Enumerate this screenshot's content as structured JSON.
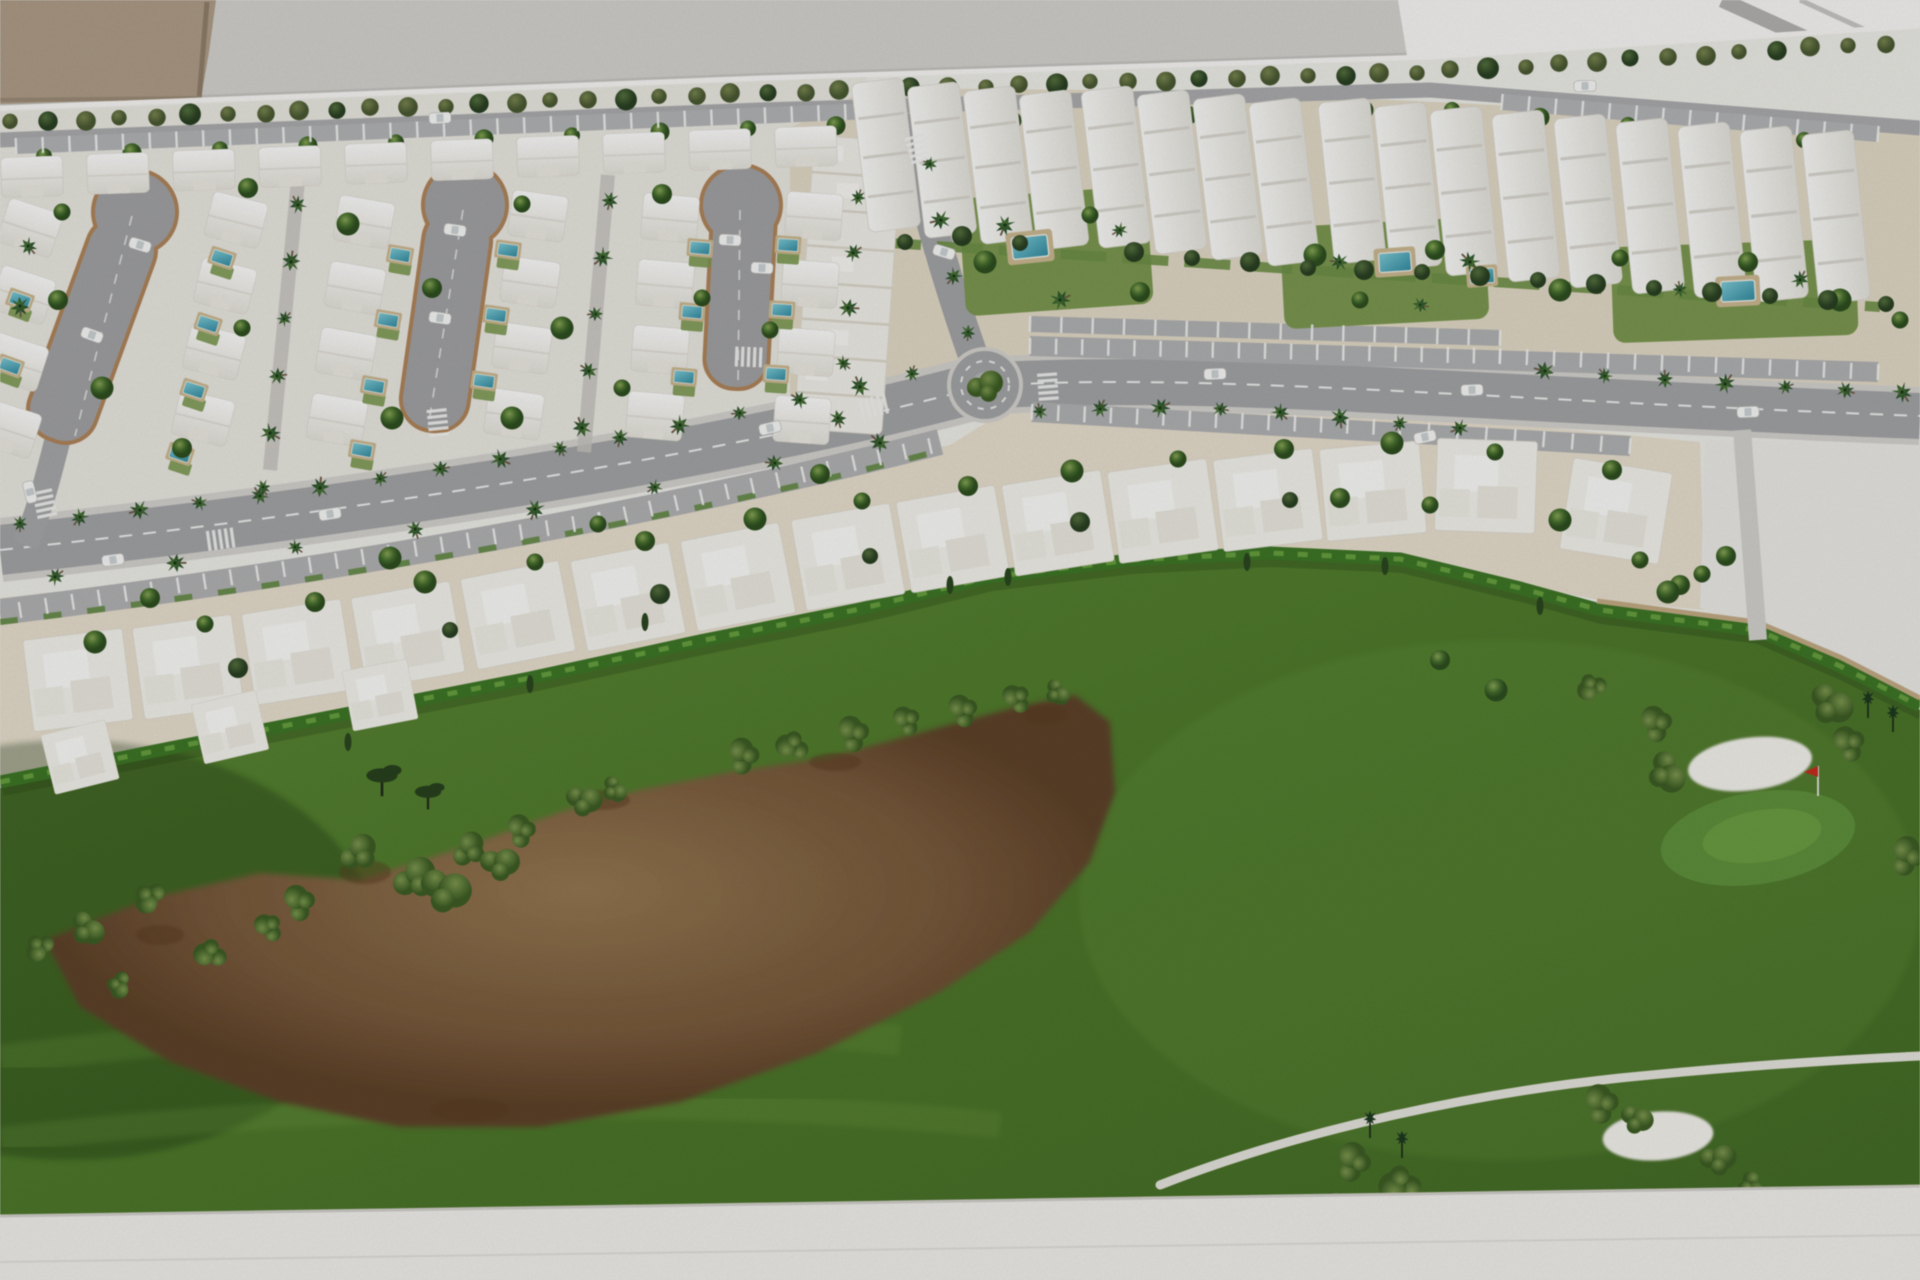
{
  "scene": {
    "palette": {
      "wall": "#d8d6d2",
      "bright": "#fbfaf8",
      "stripe": "#b7b5b2",
      "beige_object": "#b2a089",
      "board": "#f1f0eb",
      "ground_left": "#edebe3",
      "ground_tan": "#e6ddc8",
      "villa_ground": "#ebe2cf",
      "parcel": "#eeede9",
      "road": "#a7a8aa",
      "top_road": "#aeafb1",
      "lane": "#b3b4b6",
      "sidewalk": "#d8d6d1",
      "brick_edge": "#b5875a",
      "hedge": "#3e7b26",
      "grass_light": "#5d8c33",
      "grass_dark": "#456f25",
      "sand_brown": "#7c5c3b",
      "bunker": "#f6f5ef",
      "pool_water": "#3f9cb0",
      "pool_deck": "#cfbb92",
      "garden_green": "#7d9c4f",
      "tree_green": "#46702c",
      "tree_dark": "#2b4423",
      "palm_green": "#27512a",
      "flag_red": "#d22d1e",
      "car_white": "#fbfbfa",
      "base": "#f4f3ef"
    },
    "lines": {
      "edge": [
        [
          0,
          108
        ],
        [
          760,
          78
        ],
        [
          1428,
          57
        ],
        [
          1920,
          26
        ]
      ],
      "toproad": [
        [
          0,
          136
        ],
        [
          760,
          106
        ],
        [
          1430,
          86
        ],
        [
          1920,
          128
        ]
      ]
    },
    "gen": {
      "olive_row": {
        "x0": 12,
        "x1": 1908,
        "step": 36,
        "dy": 15
      },
      "row_b": {
        "x0": 44,
        "x1": 1876,
        "step": 88,
        "dy": 22,
        "skip": [
          878,
          1012
        ]
      }
    },
    "house_cols": [
      {
        "x0": 30,
        "y0": 228,
        "n": 4,
        "dx": -7,
        "dy": 67,
        "rot": 18
      },
      {
        "x0": 236,
        "y0": 220,
        "n": 4,
        "dx": -11,
        "dy": 66,
        "rot": 14
      },
      {
        "x0": 364,
        "y0": 222,
        "n": 4,
        "dx": -9,
        "dy": 66,
        "rot": 10
      },
      {
        "x0": 538,
        "y0": 216,
        "n": 4,
        "dx": -8,
        "dy": 66,
        "rot": 8
      },
      {
        "x0": 670,
        "y0": 218,
        "n": 4,
        "dx": -5,
        "dy": 66,
        "rot": 5
      },
      {
        "x0": 814,
        "y0": 216,
        "n": 4,
        "dx": -4,
        "dy": 68,
        "rot": 4
      }
    ],
    "top_row": {
      "x0": 32,
      "n": 10,
      "dx": 86,
      "dy": 42,
      "rot": -2,
      "sx": 1.1,
      "sy": 0.87
    },
    "terrace": {
      "cx": 848,
      "cy": 285,
      "w": 88,
      "h": 294,
      "rot": 4,
      "steps": 8
    },
    "villas": [
      [
        78,
        680,
        -7,
        1
      ],
      [
        188,
        667,
        -8,
        1
      ],
      [
        298,
        652,
        -9,
        1
      ],
      [
        408,
        635,
        -10,
        1
      ],
      [
        518,
        615,
        -11,
        1
      ],
      [
        628,
        597,
        -11,
        1
      ],
      [
        738,
        577,
        -11,
        1
      ],
      [
        848,
        557,
        -10,
        1
      ],
      [
        953,
        539,
        -10,
        1
      ],
      [
        1058,
        523,
        -9,
        1
      ],
      [
        1163,
        511,
        -8,
        1
      ],
      [
        1268,
        500,
        -7,
        1
      ],
      [
        1373,
        491,
        -5,
        1
      ],
      [
        1486,
        486,
        2,
        1
      ],
      [
        1616,
        511,
        9,
        1
      ],
      [
        80,
        757,
        -14,
        0.66
      ],
      [
        230,
        727,
        -13,
        0.66
      ],
      [
        380,
        695,
        -11,
        0.66
      ]
    ],
    "blocks": [
      [
        886,
        155,
        150,
        -7
      ],
      [
        942,
        160,
        152,
        -7
      ],
      [
        998,
        165,
        154,
        -7
      ],
      [
        1054,
        170,
        156,
        -7
      ],
      [
        1116,
        167,
        158,
        -7
      ],
      [
        1172,
        172,
        160,
        -7
      ],
      [
        1228,
        177,
        162,
        -7
      ],
      [
        1284,
        182,
        164,
        -7
      ],
      [
        1352,
        181,
        162,
        -6
      ],
      [
        1408,
        186,
        164,
        -6
      ],
      [
        1464,
        191,
        166,
        -6
      ],
      [
        1526,
        196,
        168,
        -6
      ],
      [
        1588,
        201,
        170,
        -6
      ],
      [
        1650,
        206,
        172,
        -6
      ],
      [
        1712,
        210,
        172,
        -6
      ],
      [
        1774,
        214,
        172,
        -6
      ],
      [
        1836,
        217,
        170,
        -6
      ]
    ],
    "pools": [
      [
        222,
        258,
        18,
        1
      ],
      [
        208,
        324,
        18,
        1
      ],
      [
        194,
        390,
        18,
        1
      ],
      [
        180,
        454,
        18,
        1
      ],
      [
        400,
        255,
        10,
        1
      ],
      [
        388,
        320,
        10,
        1
      ],
      [
        374,
        386,
        10,
        1
      ],
      [
        362,
        450,
        10,
        1
      ],
      [
        508,
        250,
        8,
        1
      ],
      [
        496,
        315,
        8,
        1
      ],
      [
        484,
        381,
        8,
        1
      ],
      [
        700,
        248,
        5,
        1
      ],
      [
        692,
        312,
        5,
        1
      ],
      [
        684,
        377,
        5,
        1
      ],
      [
        788,
        245,
        4,
        1
      ],
      [
        782,
        310,
        4,
        1
      ],
      [
        776,
        374,
        4,
        1
      ],
      [
        20,
        300,
        20,
        1
      ],
      [
        10,
        366,
        20,
        1
      ],
      [
        1030,
        247,
        -6,
        1.8
      ],
      [
        1395,
        262,
        -4,
        1.6
      ],
      [
        1482,
        276,
        -4,
        1.2
      ],
      [
        1738,
        291,
        -3,
        1.7
      ]
    ],
    "palms": [
      [
        20,
        523
      ],
      [
        80,
        517
      ],
      [
        140,
        510
      ],
      [
        200,
        503
      ],
      [
        260,
        496
      ],
      [
        320,
        488
      ],
      [
        380,
        479
      ],
      [
        440,
        469
      ],
      [
        500,
        459
      ],
      [
        560,
        448
      ],
      [
        620,
        437
      ],
      [
        680,
        425
      ],
      [
        740,
        413
      ],
      [
        800,
        400
      ],
      [
        860,
        387
      ],
      [
        912,
        374
      ],
      [
        55,
        577
      ],
      [
        175,
        563
      ],
      [
        295,
        547
      ],
      [
        415,
        529
      ],
      [
        535,
        509
      ],
      [
        655,
        487
      ],
      [
        775,
        463
      ],
      [
        880,
        443
      ],
      [
        1040,
        412
      ],
      [
        1100,
        409
      ],
      [
        1160,
        408
      ],
      [
        1220,
        409
      ],
      [
        1280,
        412
      ],
      [
        1340,
        417
      ],
      [
        1400,
        423
      ],
      [
        1460,
        428
      ],
      [
        1545,
        371
      ],
      [
        1605,
        376
      ],
      [
        1665,
        380
      ],
      [
        1725,
        384
      ],
      [
        1785,
        387
      ],
      [
        1845,
        390
      ],
      [
        1902,
        392
      ],
      [
        968,
        332
      ],
      [
        954,
        276
      ],
      [
        941,
        220
      ],
      [
        930,
        164
      ],
      [
        298,
        205
      ],
      [
        291,
        262
      ],
      [
        284,
        319
      ],
      [
        277,
        376
      ],
      [
        270,
        433
      ],
      [
        263,
        487
      ],
      [
        610,
        200
      ],
      [
        603,
        257
      ],
      [
        596,
        314
      ],
      [
        589,
        371
      ],
      [
        582,
        428
      ],
      [
        858,
        198
      ],
      [
        853,
        253
      ],
      [
        848,
        308
      ],
      [
        843,
        363
      ],
      [
        838,
        418
      ],
      [
        1005,
        225
      ],
      [
        1120,
        230
      ],
      [
        1340,
        262
      ],
      [
        1470,
        262
      ],
      [
        1680,
        290
      ],
      [
        1800,
        280
      ],
      [
        1060,
        300
      ],
      [
        1420,
        305
      ],
      [
        28,
        246
      ],
      [
        20,
        306
      ]
    ],
    "trees": [
      [
        62,
        212
      ],
      [
        248,
        188
      ],
      [
        348,
        224
      ],
      [
        522,
        204
      ],
      [
        662,
        194
      ],
      [
        102,
        388
      ],
      [
        242,
        328
      ],
      [
        432,
        288
      ],
      [
        562,
        328
      ],
      [
        702,
        298
      ],
      [
        182,
        448
      ],
      [
        392,
        418
      ],
      [
        622,
        388
      ],
      [
        58,
        300
      ],
      [
        512,
        418
      ],
      [
        770,
        330
      ],
      [
        150,
        598
      ],
      [
        390,
        558
      ],
      [
        598,
        524
      ],
      [
        820,
        474
      ],
      [
        95,
        642
      ],
      [
        205,
        624
      ],
      [
        315,
        602
      ],
      [
        425,
        582
      ],
      [
        535,
        562
      ],
      [
        645,
        541
      ],
      [
        755,
        519
      ],
      [
        862,
        501
      ],
      [
        968,
        486
      ],
      [
        1072,
        471
      ],
      [
        1178,
        459
      ],
      [
        1284,
        449
      ],
      [
        1392,
        443
      ],
      [
        1495,
        452
      ],
      [
        1612,
        470
      ],
      [
        1560,
        520
      ],
      [
        1640,
        560
      ],
      [
        1680,
        585
      ],
      [
        985,
        262
      ],
      [
        1090,
        215
      ],
      [
        1140,
        292
      ],
      [
        1315,
        255
      ],
      [
        1360,
        300
      ],
      [
        1435,
        250
      ],
      [
        1560,
        290
      ],
      [
        1620,
        258
      ],
      [
        1748,
        262
      ],
      [
        1840,
        300
      ],
      [
        1900,
        320
      ],
      [
        1440,
        660
      ],
      [
        1496,
        690
      ],
      [
        1702,
        574
      ],
      [
        1726,
        556
      ],
      [
        1668,
        592
      ],
      [
        1430,
        505
      ],
      [
        1340,
        498
      ]
    ],
    "dark_trees": [
      [
        905,
        242
      ],
      [
        962,
        236
      ],
      [
        1020,
        243
      ],
      [
        1134,
        252
      ],
      [
        1192,
        258
      ],
      [
        1250,
        262
      ],
      [
        1308,
        268
      ],
      [
        1364,
        270
      ],
      [
        1422,
        272
      ],
      [
        1480,
        276
      ],
      [
        1538,
        280
      ],
      [
        1596,
        284
      ],
      [
        1654,
        288
      ],
      [
        1712,
        292
      ],
      [
        1770,
        296
      ],
      [
        1828,
        300
      ],
      [
        1886,
        304
      ],
      [
        238,
        668
      ],
      [
        450,
        630
      ],
      [
        660,
        594
      ],
      [
        870,
        556
      ],
      [
        1080,
        522
      ],
      [
        1290,
        500
      ]
    ],
    "cypress": [
      [
        348,
        742
      ],
      [
        530,
        684
      ],
      [
        645,
        622
      ],
      [
        950,
        585
      ],
      [
        1008,
        577
      ],
      [
        1247,
        562
      ],
      [
        1385,
        566
      ],
      [
        1540,
        606
      ]
    ],
    "flat_trees": [
      [
        382,
        778,
        1.3
      ],
      [
        428,
        794,
        1.1
      ]
    ],
    "wire_palms": [
      [
        1868,
        700
      ],
      [
        1893,
        714
      ],
      [
        1370,
        1120
      ],
      [
        1402,
        1140
      ]
    ],
    "bushes": [
      [
        358,
        852,
        1.3
      ],
      [
        414,
        877,
        1.5
      ],
      [
        468,
        849,
        1.2
      ],
      [
        520,
        831,
        1.1
      ],
      [
        584,
        799,
        1.2
      ],
      [
        615,
        789,
        0.9
      ],
      [
        742,
        756,
        1.2
      ],
      [
        792,
        747,
        1.1
      ],
      [
        852,
        734,
        1.2
      ],
      [
        906,
        721,
        1.0
      ],
      [
        962,
        711,
        1.1
      ],
      [
        1016,
        699,
        1.0
      ],
      [
        1058,
        692,
        0.9
      ],
      [
        298,
        903,
        1.2
      ],
      [
        268,
        928,
        1.0
      ],
      [
        150,
        898,
        1.1
      ],
      [
        88,
        928,
        1.2
      ],
      [
        40,
        948,
        1.0
      ],
      [
        446,
        888,
        1.7
      ],
      [
        500,
        862,
        1.3
      ],
      [
        210,
        955,
        1.1
      ],
      [
        120,
        985,
        0.9
      ],
      [
        1592,
        688,
        1.0
      ],
      [
        1655,
        724,
        1.2
      ],
      [
        1668,
        772,
        1.4
      ],
      [
        1832,
        703,
        1.5
      ],
      [
        1848,
        744,
        1.2
      ],
      [
        1906,
        856,
        1.3
      ],
      [
        1600,
        1104,
        1.3
      ],
      [
        1637,
        1118,
        1.1
      ],
      [
        1718,
        1158,
        1.2
      ],
      [
        1752,
        1186,
        1.0
      ],
      [
        1352,
        1162,
        1.3
      ],
      [
        1400,
        1186,
        1.4
      ],
      [
        1336,
        1208,
        1.1
      ],
      [
        1430,
        1218,
        1.0
      ]
    ],
    "stains": [
      [
        365,
        872,
        26,
        12
      ],
      [
        600,
        800,
        30,
        10
      ],
      [
        1045,
        715,
        22,
        10
      ],
      [
        160,
        935,
        24,
        10
      ],
      [
        835,
        762,
        26,
        9
      ],
      [
        470,
        1110,
        40,
        12
      ]
    ],
    "cars": [
      [
        440,
        118,
        -3
      ],
      [
        1585,
        86,
        -2
      ],
      [
        113,
        560,
        -7
      ],
      [
        330,
        514,
        -9
      ],
      [
        770,
        428,
        -13
      ],
      [
        30,
        492,
        76
      ],
      [
        1215,
        374,
        -2
      ],
      [
        1472,
        390,
        -2
      ],
      [
        1748,
        412,
        -2
      ],
      [
        1425,
        437,
        -12
      ],
      [
        140,
        245,
        17
      ],
      [
        92,
        335,
        20
      ],
      [
        455,
        230,
        8
      ],
      [
        440,
        318,
        8
      ],
      [
        730,
        240,
        3
      ],
      [
        762,
        268,
        3
      ],
      [
        944,
        252,
        17
      ]
    ],
    "zebras": [
      [
        45,
        505,
        78
      ],
      [
        222,
        539,
        -8
      ],
      [
        438,
        424,
        84
      ],
      [
        750,
        357,
        2
      ],
      [
        875,
        406,
        -13
      ],
      [
        918,
        150,
        74
      ],
      [
        1048,
        388,
        86
      ]
    ],
    "tick_lanes": [
      {
        "x1": 16,
        "y1": 146,
        "x2": 872,
        "y2": 111,
        "step": 26
      },
      {
        "x1": 1502,
        "y1": 102,
        "x2": 1878,
        "y2": 134,
        "step": 26
      },
      {
        "x1": 20,
        "y1": 610,
        "x2": 600,
        "y2": 520,
        "step": 26
      },
      {
        "x1": 600,
        "y1": 520,
        "x2": 930,
        "y2": 446,
        "step": 26
      },
      {
        "x1": 1030,
        "y1": 346,
        "x2": 1500,
        "y2": 356,
        "step": 26
      },
      {
        "x1": 1500,
        "y1": 356,
        "x2": 1878,
        "y2": 372,
        "step": 26
      },
      {
        "x1": 1030,
        "y1": 324,
        "x2": 1500,
        "y2": 338,
        "step": 30
      },
      {
        "x1": 1032,
        "y1": 412,
        "x2": 1400,
        "y2": 428,
        "step": 26
      },
      {
        "x1": 1400,
        "y1": 428,
        "x2": 1630,
        "y2": 446,
        "step": 26
      }
    ],
    "bunkers": [
      [
        1750,
        764,
        62,
        26,
        -7
      ],
      [
        1658,
        1136,
        55,
        24,
        -4
      ]
    ],
    "flag": [
      1818,
      796
    ]
  }
}
